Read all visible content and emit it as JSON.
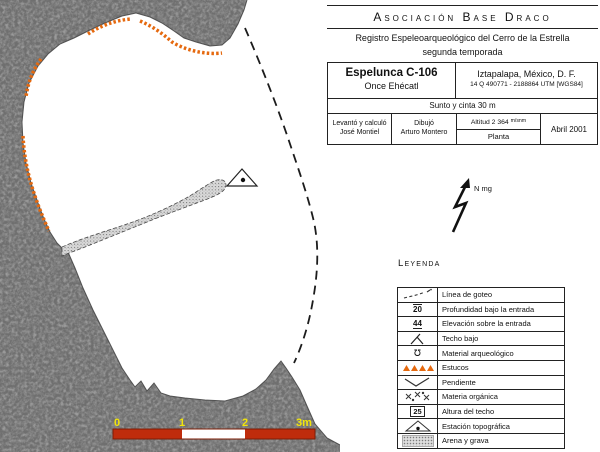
{
  "title_block": {
    "org": "Asociación Base Draco",
    "subtitle_line1": "Registro Espeleoarqueológico del Cerro de la Estrella",
    "subtitle_line2": "segunda temporada",
    "cave_name": "Espelunca C-106",
    "cave_alt_name": "Once Ehécatl",
    "location": "Iztapalapa, México, D. F.",
    "utm": "14 Q 490771 - 2188864 UTM [WGS84]",
    "survey_method": "Sunto y cinta 30 m",
    "surveyor_label": "Levantó y calculó",
    "surveyor_name": "José Montiel",
    "drawer_label": "Dibujó",
    "drawer_name": "Arturo Montero",
    "altitude": "Altitud 2 364",
    "altitude_unit": "m/snm",
    "view_type": "Planta",
    "date": "Abril 2001"
  },
  "north_arrow": {
    "label": "N mg"
  },
  "legend": {
    "heading": "Leyenda",
    "items": [
      {
        "symbol": "drip-line",
        "label": "Línea de goteo"
      },
      {
        "symbol": "depth-below-entrance",
        "label": "Profundidad bajo la entrada",
        "value": "20"
      },
      {
        "symbol": "elevation-above-entrance",
        "label": "Elevación sobre la entrada",
        "value": "44"
      },
      {
        "symbol": "low-ceiling",
        "label": "Techo bajo"
      },
      {
        "symbol": "archaeological-material",
        "label": "Material arqueológico",
        "glyph": "℧"
      },
      {
        "symbol": "stucco",
        "label": "Estucos"
      },
      {
        "symbol": "slope",
        "label": "Pendiente"
      },
      {
        "symbol": "organic-matter",
        "label": "Materia orgánica"
      },
      {
        "symbol": "ceiling-height",
        "label": "Altura del techo",
        "value": "25"
      },
      {
        "symbol": "survey-station",
        "label": "Estación topográfica"
      },
      {
        "symbol": "sand-and-gravel",
        "label": "Arena y grava"
      }
    ]
  },
  "scale_bar": {
    "labels": [
      "0",
      "1",
      "2",
      "3m"
    ]
  },
  "colors": {
    "stucco_orange": "#e5690f",
    "scale_red": "#bf2c0c",
    "scale_yellow": "#f2e50a",
    "rock_gray": "#9a9a9a"
  }
}
